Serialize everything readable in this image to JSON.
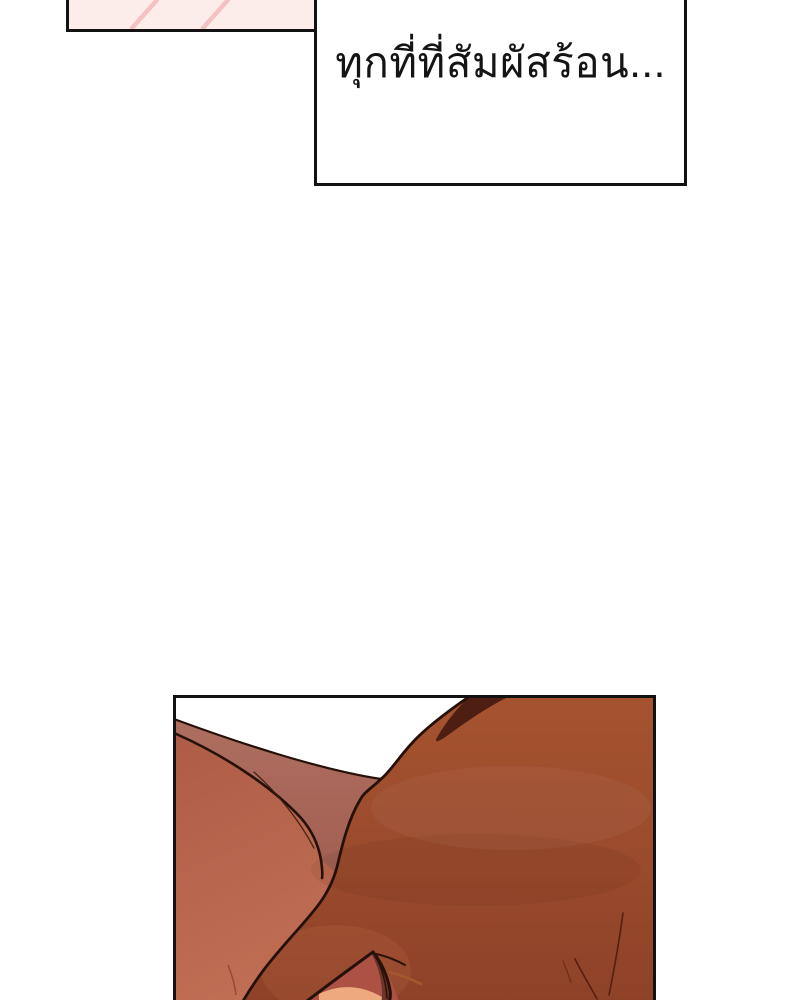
{
  "caption_box": {
    "text": "ทุกที่ที่สัมผัสร้อน...",
    "background": "#ffffff",
    "border_color": "#121212",
    "text_color": "#141414"
  },
  "flashback_panel": {
    "background": "#fcedea",
    "streak_color": "#f4bdbf",
    "border_color": "#121212"
  },
  "art_panel": {
    "background": "#ffffff",
    "border_color": "#121212",
    "outline_color": "#26110a",
    "skin": {
      "shoulder_top": "#ae5c47",
      "shoulder_bottom": "#c06e54",
      "neck_plane": "#ad6e60",
      "neck_plane_deep": "#a25e52",
      "mass_top": "#a5532f",
      "mass_mid": "#9a4a2d",
      "mass_bottom": "#8c4127",
      "shadow_wedge": "#4e1e12",
      "elbow": "#ad5145",
      "elbow_highlight": "#eeaa7e",
      "elbow_shadow": "#6d342a",
      "fold_accent": "#a55a2e",
      "strand": "#551f12",
      "crease": "#8a4330"
    }
  }
}
